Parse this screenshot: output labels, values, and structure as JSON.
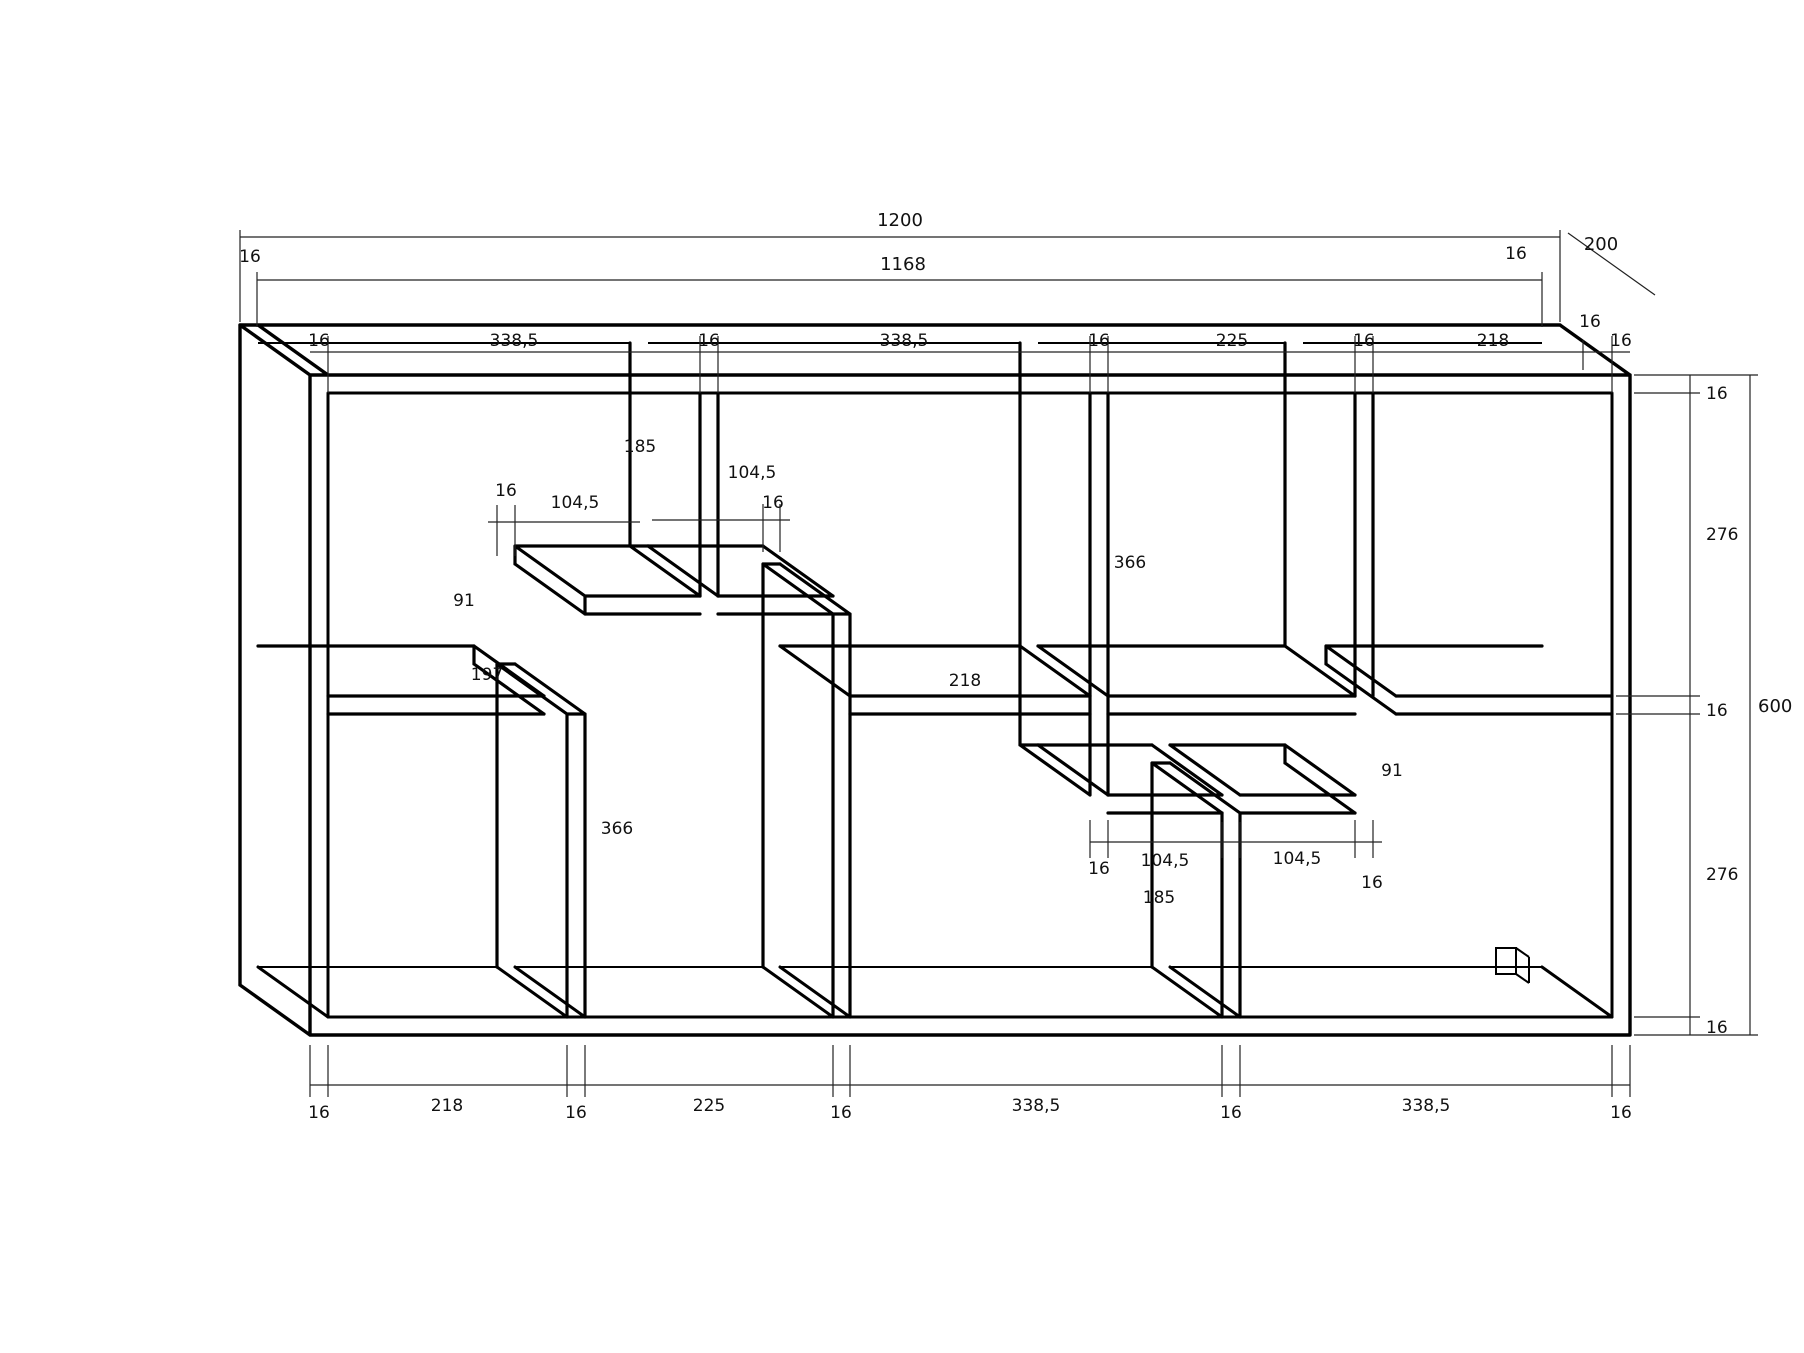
{
  "drawing": {
    "title": "shelf-unit-technical-drawing",
    "top": {
      "total": "1200",
      "inner": "1168",
      "left16": "16",
      "right16": "16",
      "depth": "200",
      "depth16": "16"
    },
    "top_row": [
      "16",
      "338,5",
      "16",
      "338,5",
      "16",
      "225",
      "16",
      "218",
      "16"
    ],
    "bottom_row": [
      "16",
      "218",
      "16",
      "225",
      "16",
      "338,5",
      "16",
      "338,5",
      "16"
    ],
    "right_col": {
      "t16": "16",
      "upper": "276",
      "m16": "16",
      "lower": "276",
      "b16": "16",
      "total": "600"
    },
    "interior": {
      "t1_height": "185",
      "b1_tick": "16",
      "s1a_width": "104,5",
      "s1b_width": "104,5",
      "b2_tick": "16",
      "gap_left": "91",
      "shelf_left_len": "197",
      "shelf_mid_len": "218",
      "b1_height": "366",
      "t2_height": "366",
      "gap_right": "91",
      "t2_tick": "16",
      "s2a_width": "104,5",
      "s2b_width": "104,5",
      "t3_tick": "16",
      "b3_height": "185"
    }
  }
}
